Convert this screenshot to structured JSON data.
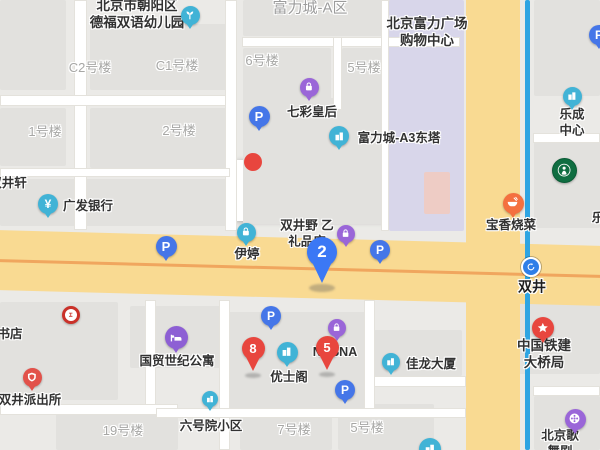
{
  "canvas": {
    "w": 600,
    "h": 450,
    "bg": "#ebeae7"
  },
  "street_box": {
    "text": "广渠门外大街",
    "x": 236,
    "y": 160,
    "w": 174,
    "h": 61
  },
  "colors": {
    "block": "#e2e1de",
    "mall": "#d8d6ea",
    "salmon": "#eeccc5",
    "road_yellow": "#f9da92",
    "road_centerline": "#f0a65e",
    "subway_line": "#2ea4e2",
    "teal": "#41b3d6",
    "purple": "#9a66d8",
    "blue": "#4576e8",
    "red": "#e8463e",
    "orange": "#f4703f",
    "pin_blue": "#3b78f5",
    "starbucks_green": "#0f6e41",
    "icbc_red": "#ca3129",
    "hotel_purple": "#8d5fd4",
    "police_red": "#e2514a"
  },
  "blocks": [
    [
      0,
      0,
      66,
      90
    ],
    [
      90,
      24,
      140,
      66
    ],
    [
      243,
      0,
      216,
      36
    ],
    [
      243,
      48,
      88,
      62
    ],
    [
      342,
      48,
      104,
      62
    ],
    [
      0,
      108,
      66,
      58
    ],
    [
      90,
      108,
      140,
      60
    ],
    [
      243,
      98,
      200,
      126
    ],
    [
      0,
      179,
      229,
      47
    ],
    [
      389,
      0,
      75,
      231,
      "mall"
    ],
    [
      424,
      172,
      26,
      42,
      "salmon"
    ],
    [
      534,
      0,
      66,
      96
    ],
    [
      534,
      142,
      66,
      86
    ],
    [
      0,
      302,
      118,
      98
    ],
    [
      130,
      306,
      92,
      62
    ],
    [
      228,
      312,
      138,
      98
    ],
    [
      374,
      330,
      88,
      46
    ],
    [
      482,
      296,
      118,
      78
    ],
    [
      56,
      414,
      122,
      36
    ],
    [
      240,
      416,
      92,
      34
    ],
    [
      338,
      404,
      96,
      46
    ],
    [
      534,
      396,
      66,
      54
    ]
  ],
  "white_roads": [
    [
      74,
      0,
      13,
      230
    ],
    [
      0,
      95,
      230,
      11
    ],
    [
      225,
      0,
      12,
      231
    ],
    [
      242,
      37,
      218,
      10
    ],
    [
      333,
      37,
      9,
      73
    ],
    [
      0,
      168,
      230,
      9
    ],
    [
      381,
      0,
      8,
      231
    ],
    [
      0,
      404,
      178,
      11
    ],
    [
      145,
      300,
      11,
      105
    ],
    [
      219,
      300,
      11,
      150
    ],
    [
      364,
      300,
      11,
      112
    ],
    [
      156,
      408,
      310,
      10
    ],
    [
      374,
      376,
      92,
      11
    ],
    [
      533,
      386,
      67,
      10
    ],
    [
      533,
      133,
      67,
      10
    ],
    [
      533,
      288,
      67,
      9
    ]
  ],
  "main_road_h": {
    "x": -10,
    "y": 238,
    "w": 620,
    "h": 60,
    "rot": 1.5,
    "line_y": 29
  },
  "main_road_v": {
    "x": 466,
    "y": -5,
    "w": 54,
    "h": 462
  },
  "subway": {
    "x": 525,
    "y": 0,
    "w": 5,
    "h": 450
  },
  "hidden_pin": {
    "x": 253,
    "y": 162,
    "r": 9,
    "color": "#e8463e"
  },
  "labels": [
    {
      "id": "label-defu-kindergarten",
      "text": "北京市朝阳区\n德福双语幼儿园",
      "x": 137,
      "y": 15,
      "cls": "poi big"
    },
    {
      "id": "label-fulicheng-a-qu",
      "text": "富力城-A区",
      "x": 310,
      "y": 9,
      "cls": "area"
    },
    {
      "id": "label-fuli-plaza-mall",
      "text": "北京富力广场\n购物中心",
      "x": 427,
      "y": 33,
      "cls": "poi big"
    },
    {
      "id": "label-c2-building",
      "text": "C2号楼",
      "x": 90,
      "y": 68,
      "cls": "bldg"
    },
    {
      "id": "label-c1-building",
      "text": "C1号楼",
      "x": 177,
      "y": 66,
      "cls": "bldg"
    },
    {
      "id": "label-no6-building",
      "text": "6号楼",
      "x": 262,
      "y": 61,
      "cls": "bldg"
    },
    {
      "id": "label-no5-building-top",
      "text": "5号楼",
      "x": 364,
      "y": 68,
      "cls": "bldg"
    },
    {
      "id": "label-no1-building",
      "text": "1号楼",
      "x": 45,
      "y": 132,
      "cls": "bldg"
    },
    {
      "id": "label-no2-building",
      "text": "2号楼",
      "x": 179,
      "y": 131,
      "cls": "bldg"
    },
    {
      "id": "label-qicai-huanghou",
      "text": "七彩皇后",
      "x": 312,
      "y": 113,
      "cls": "poi"
    },
    {
      "id": "label-fulicheng-a3",
      "text": "富力城-A3东塔",
      "x": 399,
      "y": 139,
      "cls": "poi"
    },
    {
      "id": "label-shuangjingxuan",
      "text": "双井轩",
      "x": 8,
      "y": 184,
      "cls": "poi"
    },
    {
      "id": "label-guangfa-bank",
      "text": "广发银行",
      "x": 88,
      "y": 207,
      "cls": "poi"
    },
    {
      "id": "label-lecheng-center",
      "text": "乐成中心",
      "x": 572,
      "y": 123,
      "cls": "poi"
    },
    {
      "id": "label-le-clipped",
      "text": "乐",
      "x": 598,
      "y": 219,
      "cls": "poi"
    },
    {
      "id": "label-baoxiang-shaocai",
      "text": "宝香烧菜",
      "x": 511,
      "y": 226,
      "cls": "poi"
    },
    {
      "id": "label-yiting",
      "text": "伊婷",
      "x": 247,
      "y": 255,
      "cls": "poi"
    },
    {
      "id": "label-lipin-shop",
      "text": "双井野 乙\n礼品店",
      "x": 307,
      "y": 234,
      "cls": "poi"
    },
    {
      "id": "label-shuangjing-station",
      "text": "双井",
      "x": 532,
      "y": 287,
      "cls": "station"
    },
    {
      "id": "label-bookstore",
      "text": "书店",
      "x": 10,
      "y": 335,
      "cls": "poi"
    },
    {
      "id": "label-guomao-apartment",
      "text": "国贸世纪公寓",
      "x": 177,
      "y": 362,
      "cls": "poi"
    },
    {
      "id": "label-shuangjing-police",
      "text": "双井派出所",
      "x": 30,
      "y": 401,
      "cls": "poi"
    },
    {
      "id": "label-liuhaoyuan",
      "text": "六号院小区",
      "x": 211,
      "y": 427,
      "cls": "poi"
    },
    {
      "id": "label-no19-building",
      "text": "19号楼",
      "x": 123,
      "y": 431,
      "cls": "bldg"
    },
    {
      "id": "label-no7-building",
      "text": "7号楼",
      "x": 294,
      "y": 430,
      "cls": "bldg"
    },
    {
      "id": "label-no5-building-bottom",
      "text": "5号楼",
      "x": 367,
      "y": 428,
      "cls": "bldg"
    },
    {
      "id": "label-youshige",
      "text": "优士阁",
      "x": 289,
      "y": 378,
      "cls": "poi"
    },
    {
      "id": "label-nasna",
      "text": "NASNA",
      "x": 335,
      "y": 353,
      "cls": "poi"
    },
    {
      "id": "label-jialong-tower",
      "text": "佳龙大厦",
      "x": 431,
      "y": 365,
      "cls": "poi"
    },
    {
      "id": "label-tiejian-bridge",
      "text": "中国铁建大桥局",
      "x": 544,
      "y": 355,
      "cls": "poi big"
    },
    {
      "id": "label-beijing-gewuju",
      "text": "北京歌舞剧",
      "x": 560,
      "y": 444,
      "cls": "poi"
    }
  ],
  "markers": [
    {
      "id": "marker-kindergarten",
      "icon": "sprout",
      "color": "#41b3d6",
      "x": 190,
      "y": 15,
      "d": 19
    },
    {
      "id": "marker-qicai-shop",
      "icon": "bag",
      "color": "#9a66d8",
      "x": 309,
      "y": 87,
      "d": 19
    },
    {
      "id": "marker-fulicheng-a3",
      "icon": "building",
      "color": "#41b3d6",
      "x": 339,
      "y": 136,
      "d": 20
    },
    {
      "id": "marker-parking-1",
      "icon": "p",
      "glyph": "P",
      "color": "#4576e8",
      "x": 259,
      "y": 116,
      "d": 21
    },
    {
      "id": "marker-guangfa-bank",
      "icon": "yen",
      "glyph": "¥",
      "color": "#41b3d6",
      "x": 48,
      "y": 204,
      "d": 20
    },
    {
      "id": "marker-lecheng-center",
      "icon": "building",
      "color": "#41b3d6",
      "x": 572,
      "y": 96,
      "d": 19
    },
    {
      "id": "marker-parking-2",
      "icon": "p",
      "glyph": "P",
      "color": "#4576e8",
      "x": 599,
      "y": 35,
      "d": 20
    },
    {
      "id": "marker-baoxiang-restaurant",
      "icon": "bowl",
      "color": "#f4703f",
      "x": 513,
      "y": 203,
      "d": 21
    },
    {
      "id": "marker-yiting",
      "icon": "bag",
      "color": "#41b3d6",
      "x": 246,
      "y": 232,
      "d": 19
    },
    {
      "id": "marker-parking-3",
      "icon": "p",
      "glyph": "P",
      "color": "#4576e8",
      "x": 166,
      "y": 246,
      "d": 21
    },
    {
      "id": "marker-lipin-shop",
      "icon": "bag",
      "color": "#9a66d8",
      "x": 346,
      "y": 234,
      "d": 18
    },
    {
      "id": "marker-parking-4",
      "icon": "p",
      "glyph": "P",
      "color": "#4576e8",
      "x": 380,
      "y": 250,
      "d": 20
    },
    {
      "id": "marker-shuangjing-station",
      "icon": "loop",
      "color": "#2f7fe8",
      "x": 531,
      "y": 267,
      "d": 20,
      "special": "metro"
    },
    {
      "id": "marker-icbc-bank",
      "icon": "icbc",
      "color": "#ffffff",
      "x": 71,
      "y": 315,
      "d": 18,
      "special": "icbc"
    },
    {
      "id": "marker-guomao-hotel",
      "icon": "bed",
      "color": "#8d5fd4",
      "x": 176,
      "y": 337,
      "d": 23
    },
    {
      "id": "marker-police-station",
      "icon": "police",
      "color": "#e2514a",
      "x": 32,
      "y": 377,
      "d": 19
    },
    {
      "id": "marker-liuhaoyuan",
      "icon": "building",
      "color": "#41b3d6",
      "x": 210,
      "y": 399,
      "d": 16
    },
    {
      "id": "marker-parking-5",
      "icon": "p",
      "glyph": "P",
      "color": "#4576e8",
      "x": 271,
      "y": 316,
      "d": 20
    },
    {
      "id": "marker-youshige",
      "icon": "building",
      "color": "#41b3d6",
      "x": 287,
      "y": 352,
      "d": 21
    },
    {
      "id": "marker-bag-shop-2",
      "icon": "bag",
      "color": "#9a66d8",
      "x": 337,
      "y": 328,
      "d": 18
    },
    {
      "id": "marker-parking-entrance",
      "icon": "p",
      "glyph": "P",
      "color": "#4576e8",
      "x": 345,
      "y": 390,
      "d": 20
    },
    {
      "id": "marker-jialong-tower",
      "icon": "building",
      "color": "#41b3d6",
      "x": 391,
      "y": 362,
      "d": 18
    },
    {
      "id": "marker-tiejian-bridge",
      "icon": "star",
      "color": "#e8463e",
      "x": 543,
      "y": 328,
      "d": 22
    },
    {
      "id": "marker-gewuju-theater",
      "icon": "film",
      "color": "#9a66d8",
      "x": 575,
      "y": 419,
      "d": 21
    },
    {
      "id": "marker-clipped-bottom",
      "icon": "building",
      "color": "#41b3d6",
      "x": 430,
      "y": 449,
      "d": 22
    },
    {
      "id": "marker-starbucks",
      "icon": "siren",
      "color": "#0f6e41",
      "x": 564,
      "y": 170,
      "d": 25,
      "special": "sbux"
    }
  ],
  "pins": [
    {
      "id": "pin-result-2",
      "glyph": "2",
      "color": "#3b78f5",
      "x": 322,
      "y": 284,
      "d": 30
    },
    {
      "id": "pin-result-8",
      "glyph": "8",
      "color": "#e8463e",
      "x": 253,
      "y": 373,
      "d": 23
    },
    {
      "id": "pin-result-5",
      "glyph": "5",
      "color": "#e8463e",
      "x": 327,
      "y": 372,
      "d": 23
    }
  ],
  "pin_shadows": [
    {
      "x": 322,
      "y": 288,
      "w": 26,
      "h": 8
    },
    {
      "x": 253,
      "y": 375,
      "w": 16,
      "h": 5
    },
    {
      "x": 327,
      "y": 374,
      "w": 16,
      "h": 5
    }
  ]
}
